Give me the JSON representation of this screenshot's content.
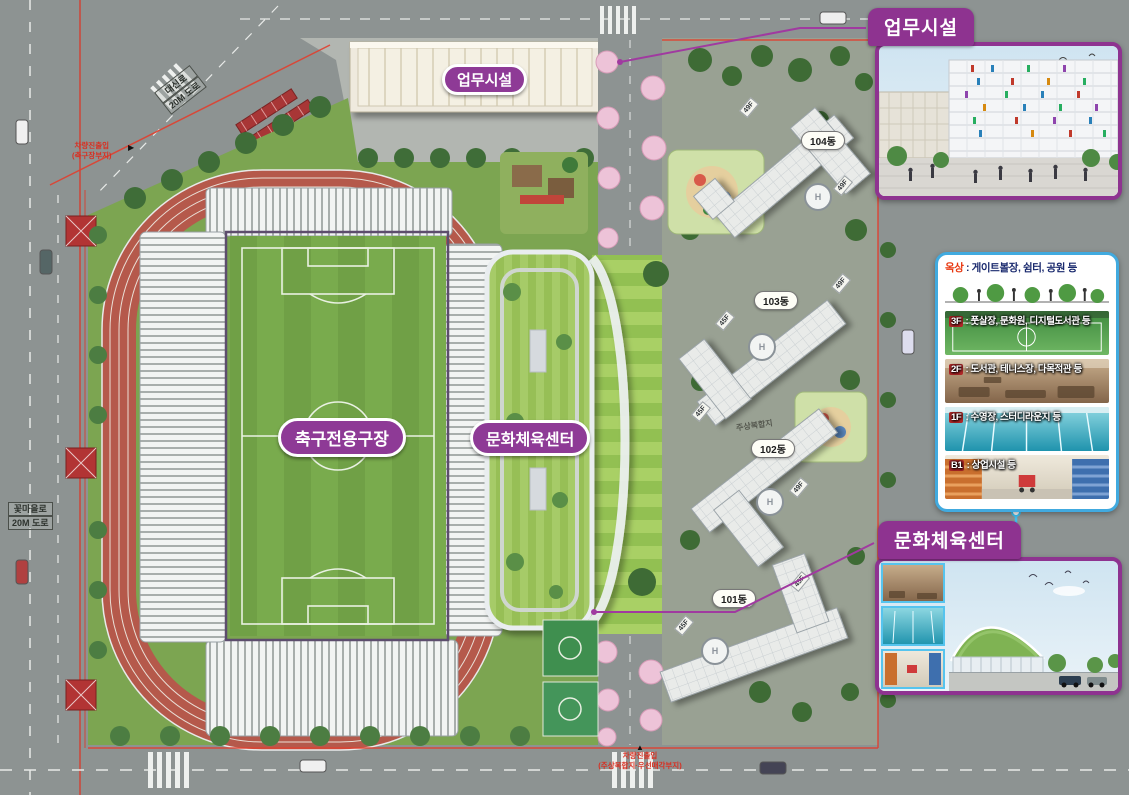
{
  "colors": {
    "accent_purple": "#8e3a96",
    "callout_purple": "#8e3390",
    "info_box_blue": "#41aadf",
    "cyan_connector": "#3fc0ef",
    "track_terracotta": "#b5594b",
    "boundary_red": "#e04030"
  },
  "plan": {
    "badges": {
      "office": "업무시설",
      "stadium": "축구전용구장",
      "culture": "문화체육센터"
    },
    "roads": {
      "top_diagonal": {
        "name": "대신로",
        "size": "20M 도로"
      },
      "left": {
        "name": "꽃마을로",
        "size": "20M 도로"
      }
    },
    "access": {
      "northwest": {
        "line1": "차량진출입",
        "line2": "(축구장부지)",
        "marker": "▶"
      },
      "south": {
        "line1": "차량진출입",
        "line2": "(주상복합지·우선매각부지)",
        "marker": "▲"
      }
    },
    "parcel_note": "주상복합지",
    "helipad_letter": "H",
    "apartments": [
      {
        "label": "104동",
        "tags": [
          "49F",
          "49F"
        ]
      },
      {
        "label": "103동",
        "tags": [
          "45F",
          "49F"
        ]
      },
      {
        "label": "102동",
        "tags": [
          "45F",
          "49F"
        ]
      },
      {
        "label": "101동",
        "tags": [
          "45F",
          "45F"
        ]
      }
    ]
  },
  "callouts": {
    "office_title": "업무시설",
    "culture_title": "문화체육센터",
    "program_box": {
      "roof": {
        "tag": "옥상",
        "text": " : 게이트볼장, 쉼터, 공원 등"
      },
      "floors": [
        {
          "tag": "3F",
          "text": " : 풋살장, 문화원, 디지털도서관 등"
        },
        {
          "tag": "2F",
          "text": " : 도서관, 테니스장, 다목적관 등"
        },
        {
          "tag": "1F",
          "text": " : 수영장, 스터디라운지 등"
        },
        {
          "tag": "B1",
          "text": " : 상업시설 등"
        }
      ]
    }
  }
}
